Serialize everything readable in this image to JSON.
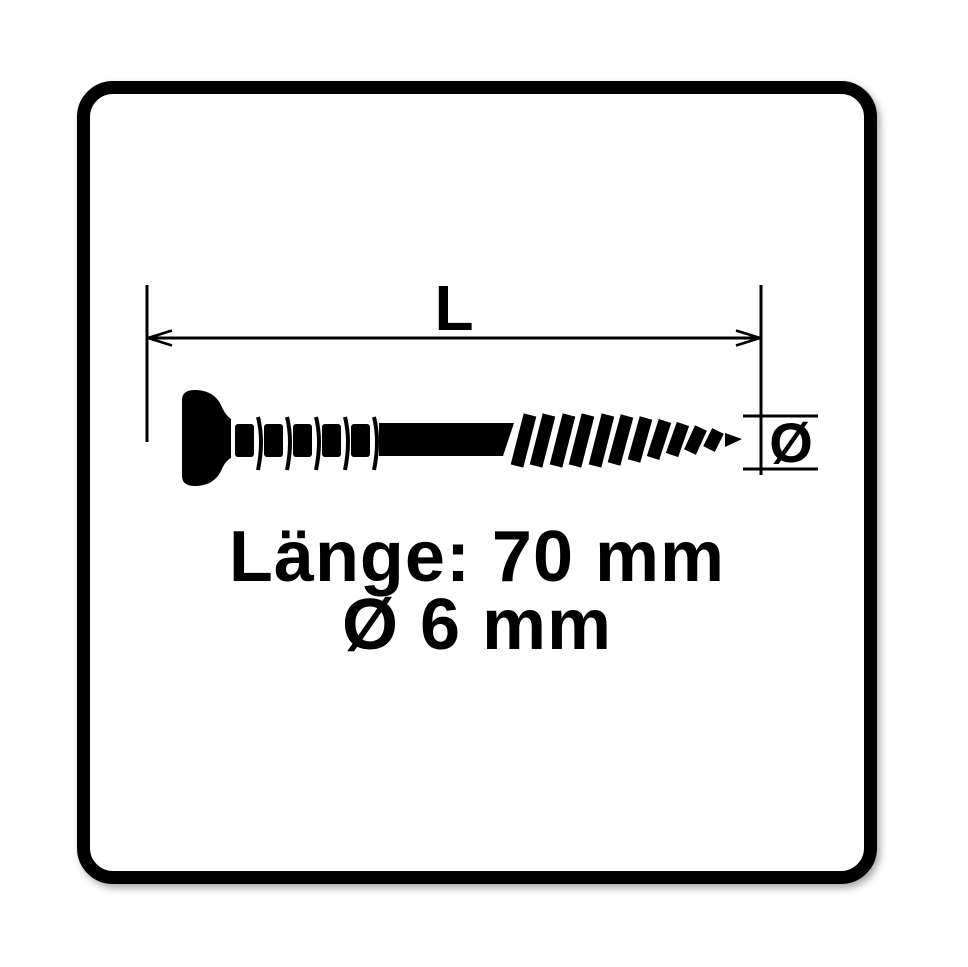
{
  "diagram": {
    "length_label": "L",
    "diameter_symbol": "Ø"
  },
  "specs": {
    "length_line": "Länge: 70 mm",
    "diameter_line": "Ø 6 mm"
  },
  "colors": {
    "ink": "#000000",
    "background": "#ffffff"
  }
}
